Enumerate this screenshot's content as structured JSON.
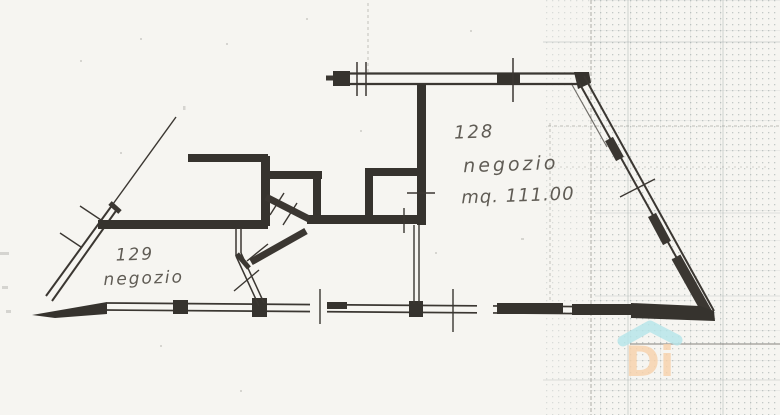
{
  "document": {
    "kind": "scanned cadastral floor plan (planimetria catastale)",
    "language": "it"
  },
  "plan": {
    "units": [
      {
        "number": "128",
        "use": "negozio",
        "area_label": "mq. 111.00"
      },
      {
        "number": "129",
        "use": "negozio"
      }
    ]
  },
  "watermark": {
    "label": "Di",
    "icon": "house-roof-icon",
    "roof_color": "#b5e6ea",
    "letter_color": "#f8d2ab"
  },
  "colors": {
    "paper": "#f6f5f1",
    "ink": "#3b3732",
    "grid": "#8f9a9a",
    "crease": "#a6a69f"
  }
}
